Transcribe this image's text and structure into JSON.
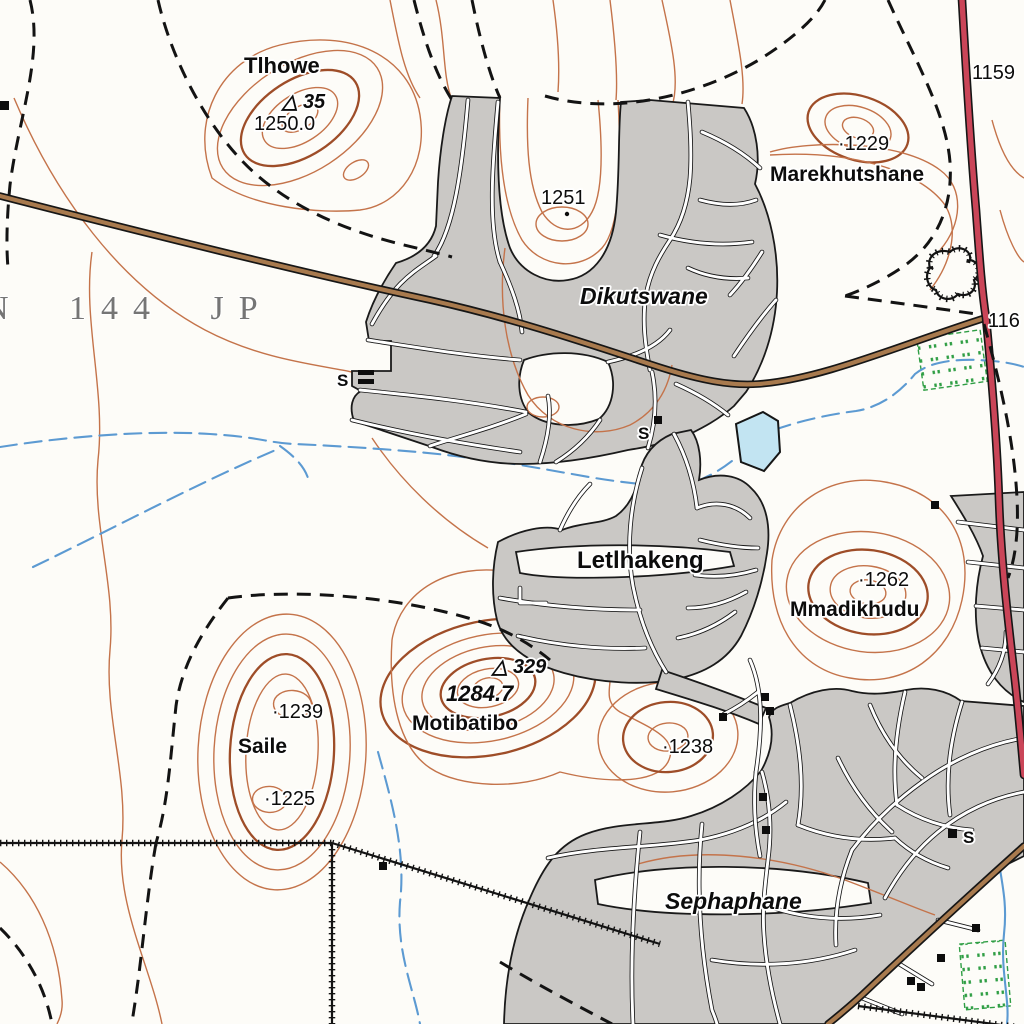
{
  "map_labels": {
    "farm_parcel": "N 144 JP",
    "villages": {
      "dikutswane": "Dikutswane",
      "letlhakeng": "Letlhakeng",
      "sephaphane": "Sephaphane"
    },
    "hills": {
      "tlhowe": "Tlhowe",
      "marekhutshane": "Marekhutshane",
      "mmadikhudu": "Mmadikhudu",
      "motibatibo": "Motibatibo",
      "saile": "Saile"
    },
    "spot_heights": {
      "tlhowe_elevation": "1250.0",
      "spot_1251": "1251",
      "spot_1229": "·1229",
      "spot_1262": "·1262",
      "motibatibo_elevation": "1284.7",
      "spot_1239": "·1239",
      "spot_1225": "·1225",
      "spot_1238": "·1238"
    },
    "trig_beacons": {
      "tlhowe": "△ 35",
      "motibatibo": "△ 329"
    },
    "route_numbers": {
      "north_route": "1159",
      "junction_route": "116"
    },
    "school_store_symbols": {
      "dikutswane_west": "S",
      "dikutswane_east": "S",
      "sephaphane": "S"
    }
  },
  "map_colors": {
    "contour": "#c4734a",
    "index_contour": "#9e4d28",
    "stream": "#5c9ad2",
    "pond_fill": "#c2e4f2",
    "settlement_fill": "#cac8c5",
    "main_road": "#a87a4e",
    "tarred_road": "#ca4558",
    "plantation_green": "#2f9e44",
    "cadastral_text": "#757575"
  }
}
